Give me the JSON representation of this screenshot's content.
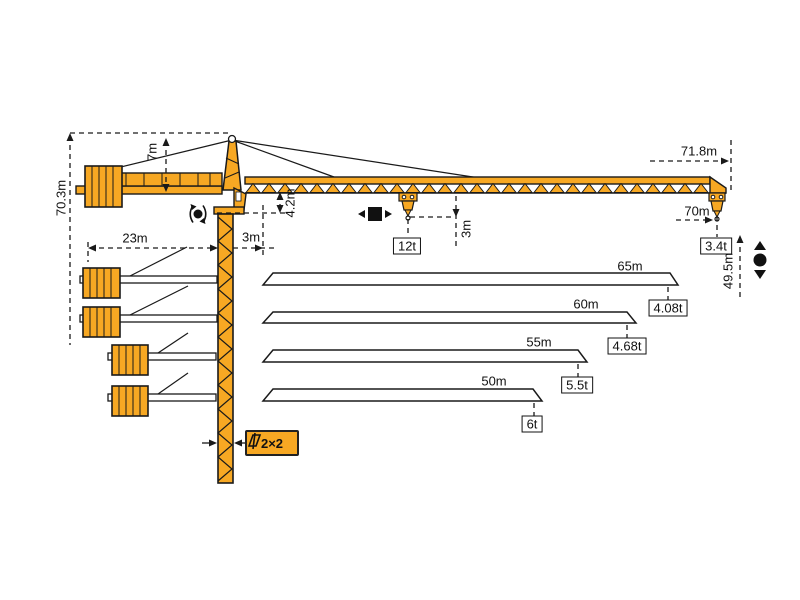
{
  "figure": {
    "kind": "tower-crane-specification-diagram",
    "colors": {
      "crane_orange": "#F7A823",
      "line_black": "#1A1A1A",
      "background": "#FFFFFF"
    },
    "dims": {
      "total_height": "70.3m",
      "head": "7m",
      "counter_jib": "23m",
      "root": "3m",
      "jib_depth": "4.2m",
      "hook": "3m",
      "tip_radius": "71.8m",
      "radius": "70m",
      "height_right": "49.5m",
      "mast_section": "2×2"
    },
    "loads": {
      "max": "12t",
      "tip": "3.4t"
    },
    "variants": [
      {
        "jib": "65m",
        "load": "4.08t"
      },
      {
        "jib": "60m",
        "load": "4.68t"
      },
      {
        "jib": "55m",
        "load": "5.5t"
      },
      {
        "jib": "50m",
        "load": "6t"
      }
    ],
    "symbols": {
      "slew": "slewing-rotation-icon",
      "trolley": "trolley-travel-icon",
      "hoist": "hoist-up-down-icon",
      "mast_section_icon": "mast-cross-section-icon"
    }
  }
}
